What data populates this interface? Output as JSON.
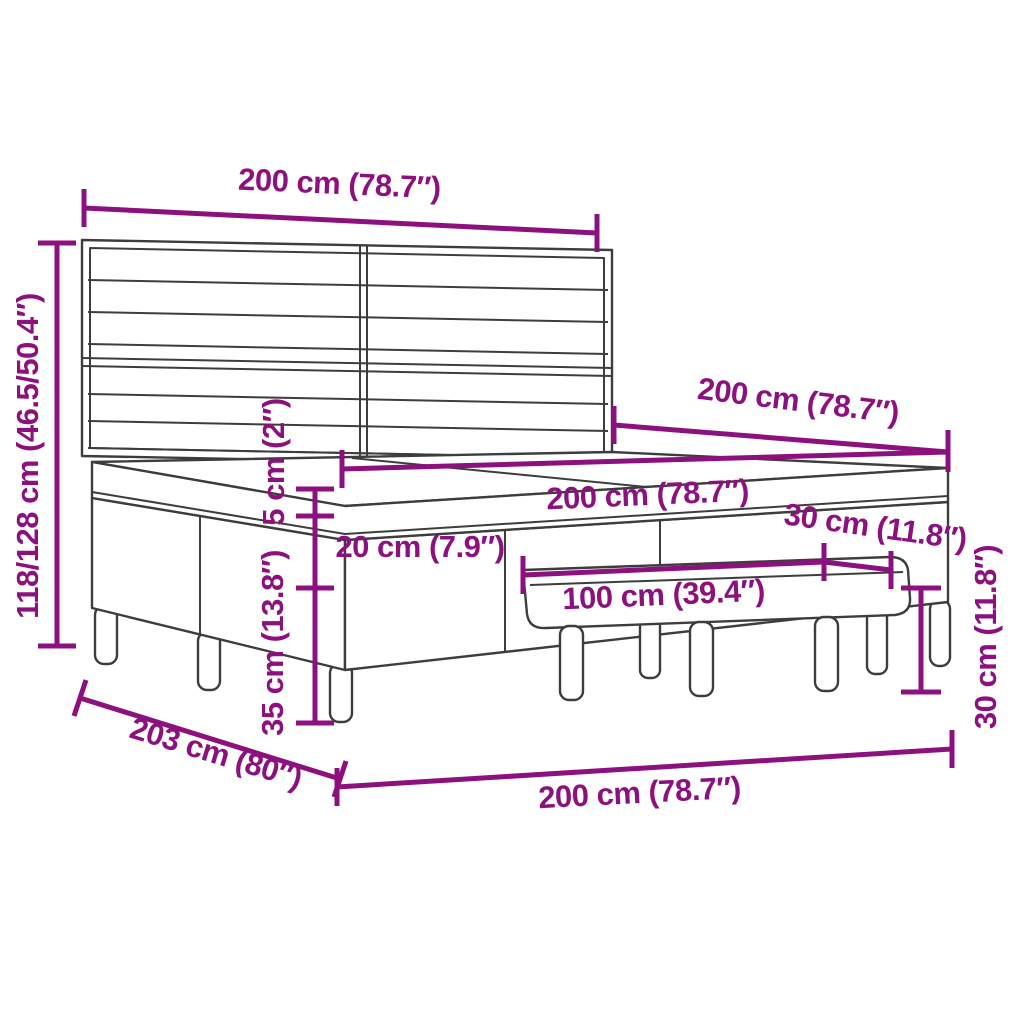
{
  "diagram": {
    "subject": "box-spring-bed-with-headboard-and-bench-dimension-diagram",
    "accent_color": "#8c117e",
    "outline_color": "#3d3d3d",
    "background_color": "#ffffff",
    "dimensions": {
      "headboard_width": "200 cm (78.7″)",
      "total_height": "118/128 cm (46.5/50.4″)",
      "bed_length": "200 cm (78.7″)",
      "mattress_width": "200 cm (78.7″)",
      "topper_height": "5 cm (2″)",
      "mattress_height": "20 cm (7.9″)",
      "base_height": "35 cm (13.8″)",
      "bench_length": "100 cm (39.4″)",
      "bench_depth": "30 cm (11.8″)",
      "bench_height": "30 cm (11.8″)",
      "total_length": "203 cm (80″)",
      "bed_width": "200 cm (78.7″)"
    }
  }
}
